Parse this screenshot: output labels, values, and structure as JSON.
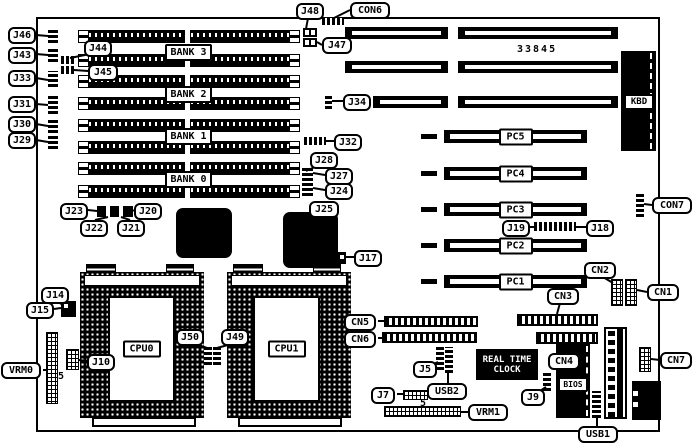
{
  "diagram": {
    "board_number": "33845",
    "pin_marker": "5",
    "banks": [
      "BANK 3",
      "BANK 2",
      "BANK 1",
      "BANK 0"
    ],
    "pci_slots": [
      "PC5",
      "PC4",
      "PC3",
      "PC2",
      "PC1"
    ],
    "cpu_sockets": [
      "CPU0",
      "CPU1"
    ],
    "rtc": {
      "line1": "REAL TIME",
      "line2": "CLOCK"
    },
    "chips": {
      "kbd": "KBD",
      "bios": "BIOS"
    },
    "connectors": {
      "j46": "J46",
      "j43": "J43",
      "j33": "J33",
      "j31": "J31",
      "j30": "J30",
      "j29": "J29",
      "j44": "J44",
      "j45": "J45",
      "j48": "J48",
      "con6": "CON6",
      "j47": "J47",
      "j34": "J34",
      "j32": "J32",
      "j28": "J28",
      "j27": "J27",
      "j24": "J24",
      "j25": "J25",
      "j17": "J17",
      "j23": "J23",
      "j20": "J20",
      "j22": "J22",
      "j21": "J21",
      "j14": "J14",
      "j15": "J15",
      "vrm0": "VRM0",
      "j10": "J10",
      "j50": "J50",
      "j49": "J49",
      "cn5": "CN5",
      "cn6": "CN6",
      "j19": "J19",
      "j18": "J18",
      "con7": "CON7",
      "cn2": "CN2",
      "cn1": "CN1",
      "cn3": "CN3",
      "cn4": "CN4",
      "j5": "J5",
      "usb2": "USB2",
      "j7": "J7",
      "vrm1": "VRM1",
      "j9": "J9",
      "usb1": "USB1",
      "cn7": "CN7"
    }
  }
}
